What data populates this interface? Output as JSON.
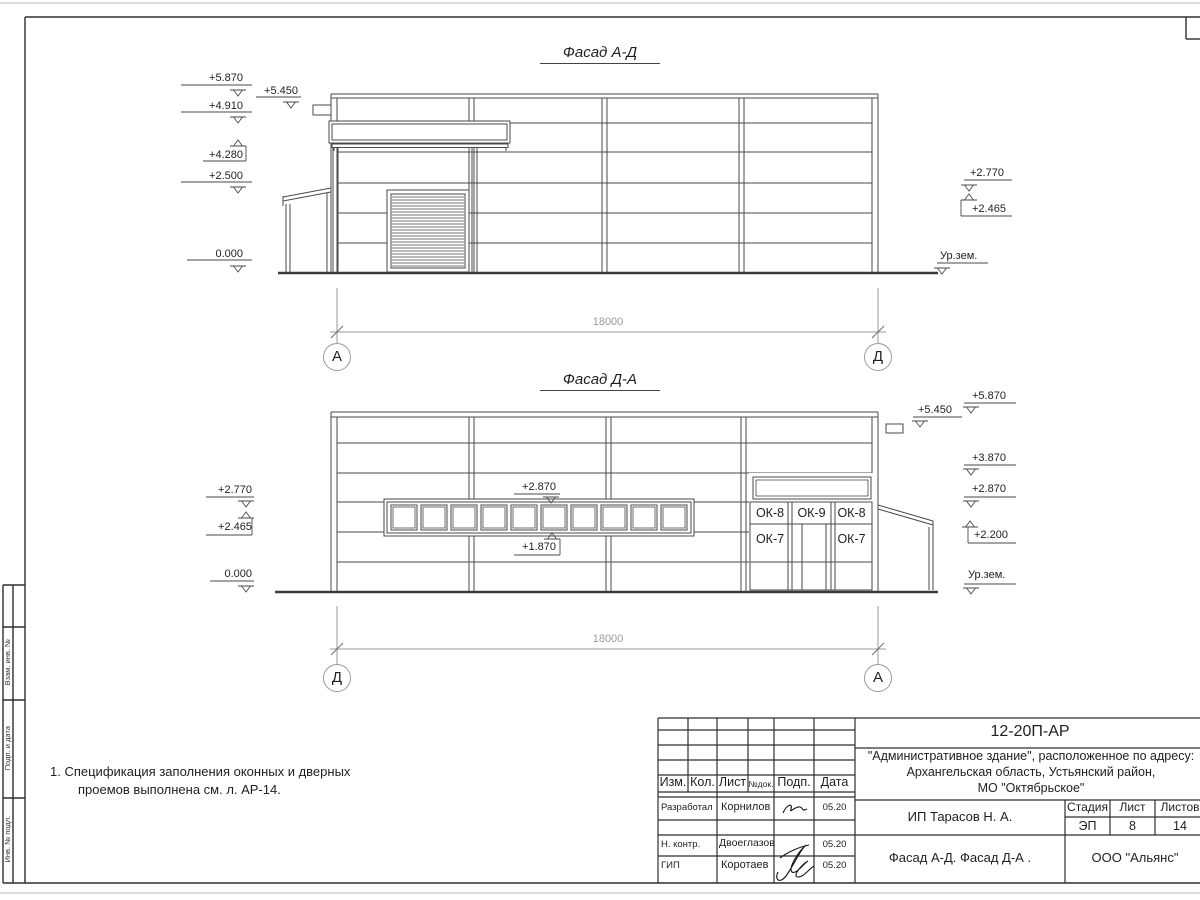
{
  "colors": {
    "line": "#4a4a4a",
    "dim_line": "#9a9a9a",
    "text": "#1f1f1f"
  },
  "facades": {
    "top": {
      "title": "Фасад А-Д",
      "dimension": "18000",
      "axis_left": "А",
      "axis_right": "Д",
      "marks_left": [
        "+5.870",
        "+4.910",
        "+4.280",
        "+2.500",
        "0.000"
      ],
      "mark_5450": "+5.450",
      "marks_right": [
        "+2.770",
        "+2.465"
      ],
      "ground": "Ур.зем."
    },
    "bottom": {
      "title": "Фасад Д-А",
      "dimension": "18000",
      "axis_left": "Д",
      "axis_right": "А",
      "marks_left": [
        "+2.770",
        "+2.465",
        "0.000"
      ],
      "band_marks": [
        "+2.870",
        "+1.870"
      ],
      "marks_right": [
        "+5.870",
        "+5.450",
        "+3.870",
        "+2.870",
        "+2.200"
      ],
      "ground": "Ур.зем.",
      "window_tags": {
        "ok8": "ОК-8",
        "ok9": "ОК-9",
        "ok7": "ОК-7"
      }
    }
  },
  "note": {
    "line1": "1. Спецификация заполнения оконных и дверных",
    "line2": "проемов выполнена см. л. АР-14."
  },
  "title_block": {
    "code": "12-20П-АР",
    "project_line1": "\"Административное здание\", расположенное по адресу:",
    "project_line2": "Архангельская область, Устьянский район,",
    "project_line3": "МО \"Октябрьское\"",
    "header": {
      "izm": "Изм.",
      "kol": "Кол.",
      "list": "Лист",
      "ndok": "№док.",
      "podp": "Подп.",
      "data": "Дата"
    },
    "rows": [
      {
        "role": "Разработал",
        "name": "Корнилов",
        "date": "05.20"
      },
      {
        "role": "Н. контр.",
        "name": "Двоеглазов",
        "date": "05.20"
      },
      {
        "role": "ГИП",
        "name": "Коротаев",
        "date": "05.20"
      }
    ],
    "stage_header": {
      "stage": "Стадия",
      "sheet": "Лист",
      "sheets": "Листов"
    },
    "stage_values": {
      "stage": "ЭП",
      "sheet": "8",
      "sheets": "14"
    },
    "client": "ИП Тарасов Н. А.",
    "sheet_title": "Фасад А-Д. Фасад Д-А .",
    "company": "ООО \"Альянс\""
  },
  "side_strip": {
    "labels": [
      "Взам. инв. №",
      "Подп. и дата",
      "Инв. № подл."
    ]
  }
}
